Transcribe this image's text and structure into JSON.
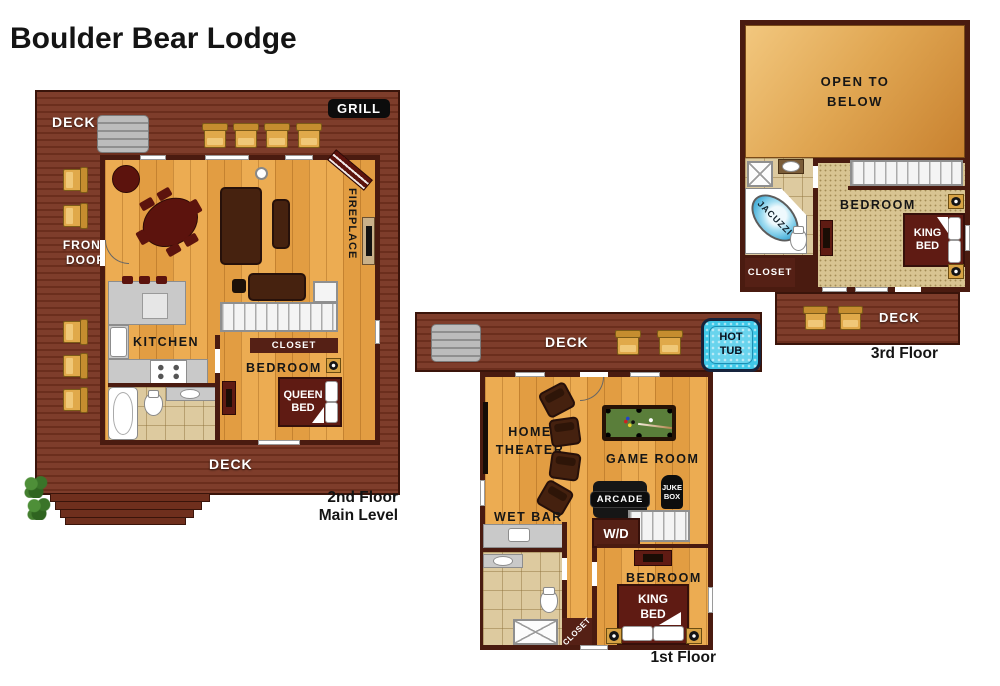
{
  "title": "Boulder Bear Lodge",
  "colors": {
    "deck_brown": "#7E3D2B",
    "wall_brown": "#4A1B10",
    "wood_floor": "#E9A84F",
    "carpet_tan": "#D8C492",
    "tile_tan": "#DDCA9F",
    "bed_maroon": "#5F1B13",
    "hot_tub_blue": "#3FC8E8",
    "pool_felt_green": "#5A7E3A",
    "open_below_gradient_start": "#F2C77E",
    "open_below_gradient_end": "#C8812F"
  },
  "floor2": {
    "caption_line1": "2nd Floor",
    "caption_line2": "Main Level",
    "deck_top_label": "DECK",
    "grill_label": "GRILL",
    "front_door_label": "FRONT DOOR",
    "fireplace_label": "FIREPLACE",
    "kitchen_label": "KITCHEN",
    "closet_label": "CLOSET",
    "bedroom_label": "BEDROOM",
    "queen_bed_label": "QUEEN BED",
    "deck_bottom_label": "DECK"
  },
  "floor1": {
    "caption": "1st Floor",
    "deck_label": "DECK",
    "hot_tub_label": "HOT TUB",
    "home_theater_label": "HOME THEATER",
    "game_room_label": "GAME ROOM",
    "arcade_label": "ARCADE",
    "juke_box_label": "JUKE BOX",
    "wet_bar_label": "WET BAR",
    "washer_dryer_label": "W/D",
    "bedroom_label": "BEDROOM",
    "king_bed_label": "KING BED",
    "closet_label": "CLOSET"
  },
  "floor3": {
    "caption": "3rd Floor",
    "open_to_below_label": "OPEN TO BELOW",
    "jacuzzi_label": "JACUZZI",
    "bedroom_label": "BEDROOM",
    "king_bed_label": "KING BED",
    "closet_label": "CLOSET",
    "deck_label": "DECK"
  }
}
